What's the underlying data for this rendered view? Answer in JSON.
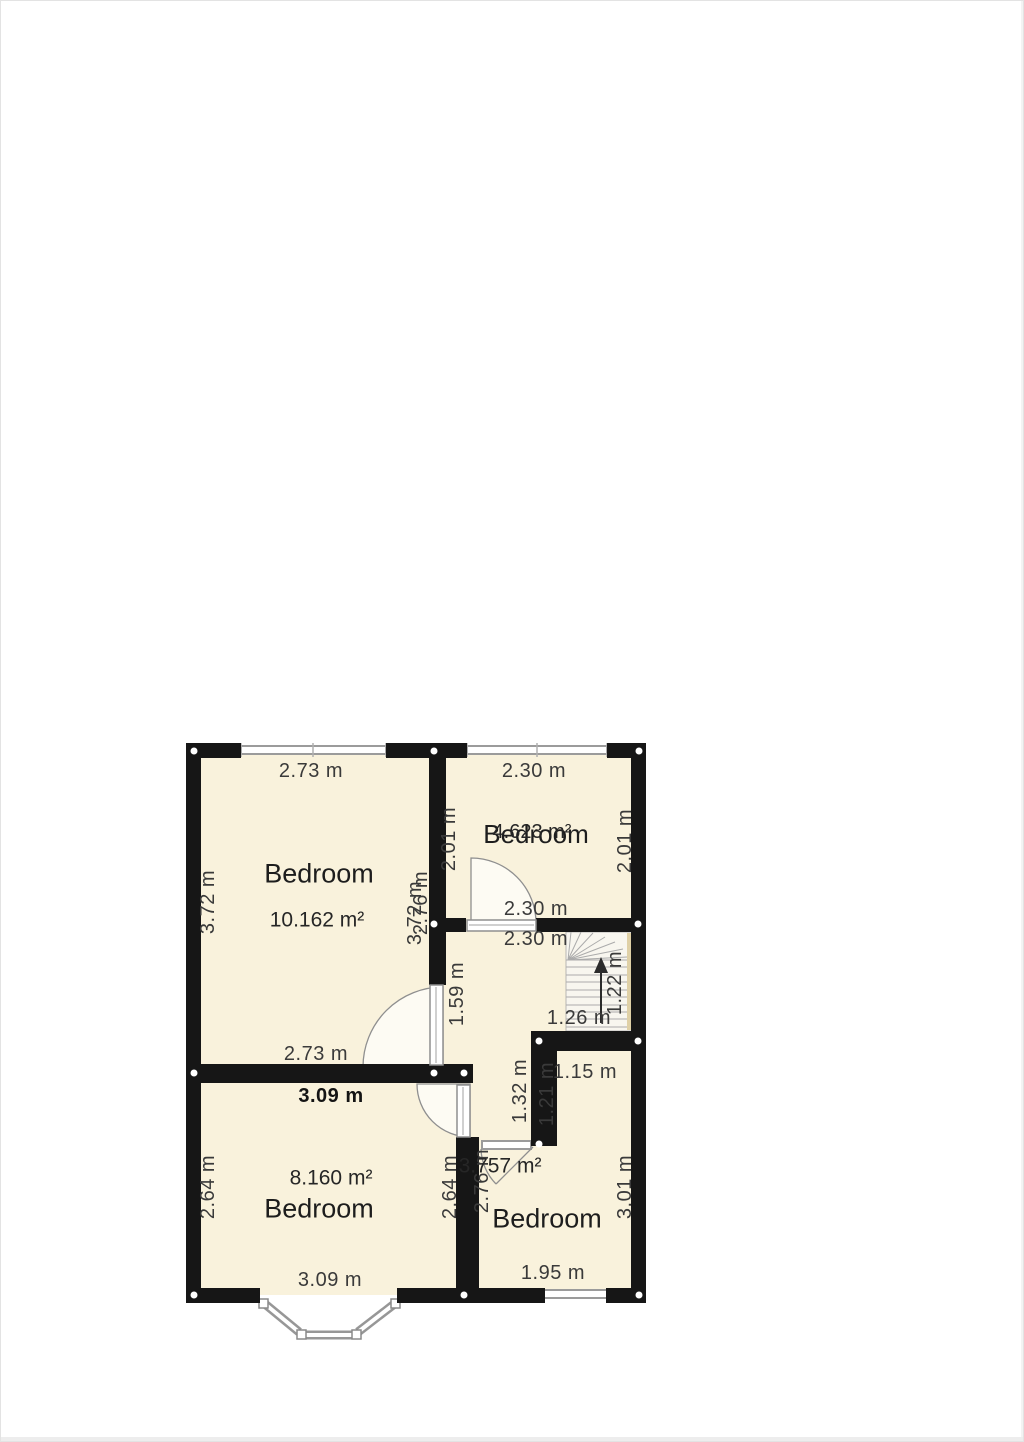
{
  "page": {
    "background": "#ffffff",
    "edge_color": "#e3e3e3"
  },
  "plan": {
    "type": "floor-plan",
    "wall_color": "#161616",
    "floor_color": "#f9f2dc",
    "window_color": "#999999",
    "corner_dot_color": "#ffffff",
    "rooms": [
      {
        "name": "Bedroom",
        "area": "10.162 m²",
        "width": "2.73 m",
        "height": "3.72 m"
      },
      {
        "name": "Bedroom",
        "area": "4.623 m²",
        "width": "2.30 m",
        "height": "2.01 m"
      },
      {
        "name": "Bedroom",
        "area": "8.160 m²",
        "width": "3.09 m",
        "height": "2.64 m"
      },
      {
        "name": "Bedroom",
        "area": "3.757 m²",
        "width": "1.95 m",
        "height": "3.01 m"
      },
      {
        "name": "stairs-landing",
        "stair_width": "1.26 m",
        "stair_depth": "1.22 m"
      }
    ],
    "dim_labels": [
      {
        "t": "2.73 m",
        "x": 310,
        "y": 770,
        "r": 0
      },
      {
        "t": "2.30 m",
        "x": 533,
        "y": 770,
        "r": 0
      },
      {
        "t": "3.72 m",
        "x": 207,
        "y": 901,
        "r": -90
      },
      {
        "t": "2.01 m",
        "x": 448,
        "y": 838,
        "r": -90
      },
      {
        "t": "2.01 m",
        "x": 624,
        "y": 840,
        "r": -90
      },
      {
        "t": "3.72 m",
        "x": 414,
        "y": 912,
        "r": -90
      },
      {
        "t": "2.76 m",
        "x": 420,
        "y": 902,
        "r": -90
      },
      {
        "t": "2.30 m",
        "x": 535,
        "y": 908,
        "r": 0
      },
      {
        "t": "2.30 m",
        "x": 535,
        "y": 938,
        "r": 0
      },
      {
        "t": "1.59 m",
        "x": 456,
        "y": 993,
        "r": -90
      },
      {
        "t": "1.22 m",
        "x": 614,
        "y": 982,
        "r": -90
      },
      {
        "t": "1.26 m",
        "x": 578,
        "y": 1017,
        "r": 0
      },
      {
        "t": "1.15 m",
        "x": 584,
        "y": 1071,
        "r": 0
      },
      {
        "t": "1.32 m",
        "x": 519,
        "y": 1090,
        "r": -90
      },
      {
        "t": "1.21 m",
        "x": 546,
        "y": 1093,
        "r": -90
      },
      {
        "t": "2.73 m",
        "x": 315,
        "y": 1053,
        "r": 0
      },
      {
        "t": "3.09 m",
        "x": 330,
        "y": 1095,
        "r": 0,
        "b": true
      },
      {
        "t": "2.64 m",
        "x": 207,
        "y": 1186,
        "r": -90
      },
      {
        "t": "2.64 m",
        "x": 449,
        "y": 1186,
        "r": -90
      },
      {
        "t": "2.76 m",
        "x": 481,
        "y": 1180,
        "r": -90
      },
      {
        "t": "3.01 m",
        "x": 624,
        "y": 1186,
        "r": -90
      },
      {
        "t": "3.09 m",
        "x": 329,
        "y": 1279,
        "r": 0
      },
      {
        "t": "1.95 m",
        "x": 552,
        "y": 1272,
        "r": 0
      }
    ],
    "text_labels": [
      {
        "t": "Bedroom",
        "x": 318,
        "y": 873,
        "s": 27,
        "cls": "room-name"
      },
      {
        "t": "10.162 m²",
        "x": 316,
        "y": 919,
        "s": 21,
        "cls": "room-area"
      },
      {
        "t": "Bedroom",
        "x": 535,
        "y": 833,
        "s": 26,
        "cls": "room-name"
      },
      {
        "t": "4.623 m²",
        "x": 531,
        "y": 831,
        "s": 20,
        "cls": "room-area"
      },
      {
        "t": "8.160 m²",
        "x": 330,
        "y": 1177,
        "s": 21,
        "cls": "room-area"
      },
      {
        "t": "Bedroom",
        "x": 318,
        "y": 1208,
        "s": 27,
        "cls": "room-name"
      },
      {
        "t": "3.757 m²",
        "x": 499,
        "y": 1165,
        "s": 21,
        "cls": "room-area"
      },
      {
        "t": "Bedroom",
        "x": 546,
        "y": 1218,
        "s": 27,
        "cls": "room-name"
      }
    ]
  }
}
